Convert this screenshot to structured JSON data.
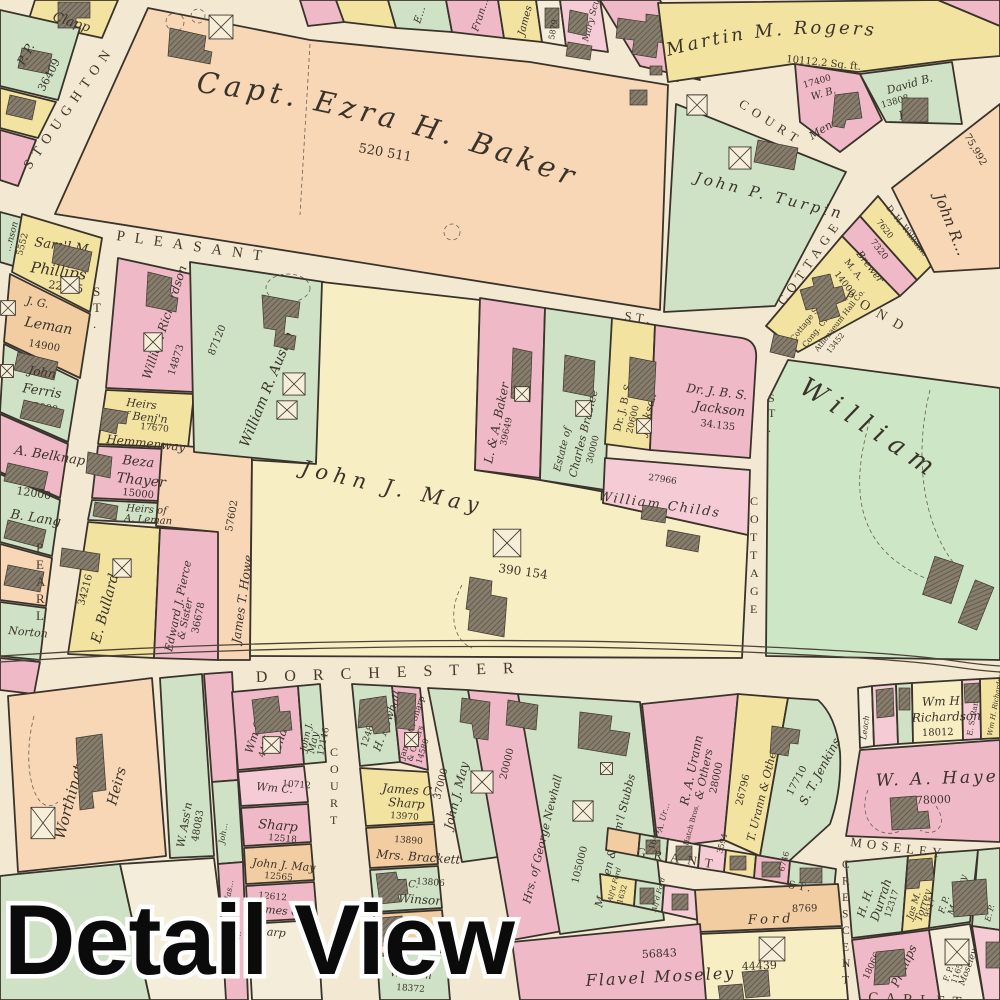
{
  "overlay": {
    "caption": "Detail View"
  },
  "palette": {
    "street": "#f3e9d2",
    "peach": "#f8d7b6",
    "pink": "#f0b9c7",
    "pinkl": "#f5ccd5",
    "yellow": "#f3e3a0",
    "yellowp": "#f7eec3",
    "green": "#cfe2c6",
    "greenb": "#cde6c6",
    "tan": "#f2cda2",
    "cream": "#f4edda",
    "ink": "#3a332a",
    "outline": "#39332b",
    "ovlfill": "#0b0b0b",
    "ovlstroke": "#ffffff"
  },
  "streets": {
    "stoughton": "STOUGHTON",
    "pearl": "PEARL",
    "pearl_st": "ST.",
    "pleasant": "PLEASANT",
    "pleasant_st": "ST.",
    "court_top": "COURT",
    "cottage_up": "COTTAGE",
    "cottage_lo": "COTTAGE",
    "cottage_lo_st": "ST.",
    "pond": "POND",
    "dorchester": "DORCHESTER",
    "court_bot": "COURT",
    "grant": "GRANT",
    "grant_st": "ST.",
    "moseley": "MOSELEY",
    "crescent": "CRESCENT",
    "carleton": "CARLET"
  },
  "labels": {
    "clapp": "Clapp",
    "pp": "P. P.",
    "pp_n": "36409",
    "nson": "…nson",
    "nson_n": "5552",
    "saml": "Sam'l M.",
    "saml2": "Phillips",
    "saml_n": "22275",
    "jg": "J. G.",
    "jg2": "Leman",
    "jg_n": "14900",
    "ferris": "John",
    "ferris2": "Ferris",
    "ferris_n": "15000",
    "belknap": "A. Belknap",
    "lang_n": "12000",
    "lang": "B. Lang",
    "norton": "Norton",
    "baker": "Capt. Ezra H. Baker",
    "baker_n": "520 511",
    "trow_e": "E…",
    "trow_fran": "Fran…",
    "trow_james": "James",
    "trow_n": "5879",
    "trow_scudder": "Mary Scudder",
    "city": "CITY OF",
    "rogers": "Martin M. Rogers",
    "rogers_n": "10112.2 Sq. ft.",
    "mendum_n": "17400",
    "mendum1": "W. B.",
    "mendum": "Mendum",
    "flint1": "David B.",
    "flint_n": "13808",
    "flint": "Flint",
    "turpin": "John P. Turpin",
    "johnr": "John R…",
    "johnr_n": "75,992",
    "will1": "D. H. Williams",
    "will_n": "7620",
    "brewer_n": "7320",
    "brewer1": "M. A.",
    "brewer": "Brewer",
    "brewer_n2": "14000",
    "church1": "Cottage St.",
    "church2": "Cong. Ch.",
    "hall": "Athenaeum Hall Co.",
    "hall_n": "13452",
    "austin": "William R. Austin",
    "austin_n": "87120",
    "wrich": "William Richardson",
    "wrich_n": "14873",
    "hem1": "Heirs",
    "hem2": "of Benj'n",
    "hem_n": "17670",
    "hem3": "Hemmenway",
    "thayer1": "Beza",
    "thayer2": "Thayer",
    "thayer_n": "15000",
    "alem_n": "6730",
    "alem1": "Heirs of",
    "alem2": "A. Leman",
    "bullard": "E. Bullard",
    "bullard_n": "34216",
    "pierce1": "Edward J. Pierce",
    "pierce2": "& Sister",
    "pierce_n": "36678",
    "howe_n": "57602",
    "howe": "James T. Howe",
    "lab": "L. & A. Baker",
    "lab_n": "39649",
    "brad1": "Estate of",
    "brad2": "Charles Bradlee",
    "brad_n": "30000",
    "jacy1": "Dr. J. B. S.",
    "jacy_n": "20600",
    "jacy2": "Jackson",
    "jack1": "Dr. J. B. S.",
    "jack2": "Jackson",
    "jack_n": "34.135",
    "childs_n": "27966",
    "childs": "William Childs",
    "may": "John J. May",
    "may_n": "390 154",
    "william": "William",
    "worth1": "Worthington",
    "worth2": "Heirs",
    "wassn": "W. Ass'n",
    "wassn_n": "48083",
    "wassn2": "W. Ass'n",
    "wassn2_n": "18372",
    "s_joh": "Joh…",
    "s_jas": "Jas…",
    "s_sh": "Sh…",
    "wmc1": "Wm C.",
    "wmc1_n": "4485",
    "wmc1b": "Sharp",
    "jjm1": "John J.",
    "jjm1b": "May",
    "jjm1_n": "12146",
    "wmc2": "Wm C.",
    "wmc2_n": "10712",
    "shp3": "Sharp",
    "shp3_n": "12518",
    "jjm2": "John J. May",
    "jjm2_n": "12565",
    "jcs_n": "12612",
    "jcs": "James C.",
    "jcsb": "Sharp",
    "nh_n": "12489",
    "nh": "H. Newhall",
    "jcso": "James C. Sharp",
    "jcso2": "& Others",
    "jcso_n": "14580",
    "jcs2a": "James C.",
    "jcs2b": "Sharp",
    "jcs2_n": "13970",
    "brack_n": "13890",
    "brack": "Mrs. Brackett",
    "win1": "G. C.",
    "win_n": "13806",
    "win2": "Winsor",
    "orc_n": "13719",
    "jjm3": "John J. May",
    "jjm3_n": "37000",
    "gnew": "Hrs. of George Newhall",
    "gnew_n": "20000",
    "stubbs": "M. Allen & Sam'l Stubbs",
    "stubbs_n": "105000",
    "ura1": "R. A. Urann",
    "ura2": "& Others",
    "ura_n": "28000",
    "tura": "T. Urann & Others",
    "tura_n": "26796",
    "jenk": "S. T. Jenkins",
    "jenk_n": "17710",
    "leach": "Leach",
    "wmh1": "Wm H.",
    "wmh2": "Richardson",
    "wmh_n": "18012",
    "rand": "E. S. Rand Jr.",
    "wmhv": "Wm H. Richardson",
    "hayes": "W. A. Hayes",
    "hayes_n": "78000",
    "dur1": "H. H.",
    "dur2": "Durrah",
    "dur_n": "12317",
    "tor1": "Jas M.",
    "tor2": "Torrey",
    "tor_n": "9517",
    "fpm1": "F. P.",
    "fpm1b": "Moseley",
    "fpm1_n": "8493",
    "smp1": "S. M.",
    "smp2": "Phillips",
    "smp_n": "18066",
    "fpm2": "F. P.",
    "fpm2_n": "11655",
    "fpm2b": "Moseley",
    "ep": "E. P.",
    "flavel": "Flavel Moseley",
    "flavel_n": "56843",
    "ford": "Ford",
    "ford_n": "8769",
    "y44": "44439",
    "g1_n": "1644",
    "g1": "A. Ur…",
    "g2": "Hatch Bros.",
    "g3_n": "3594",
    "g4_n": "6746",
    "gs1": "Alf'd Ford",
    "gs1_n": "1632",
    "gs2": "Alf'd Ford"
  }
}
